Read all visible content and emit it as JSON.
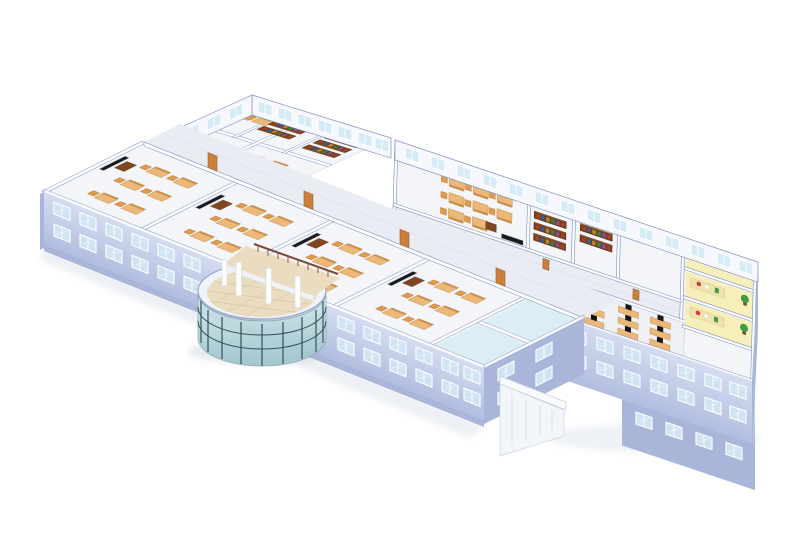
{
  "canvas": {
    "width": 800,
    "height": 550,
    "background": "#ffffff"
  },
  "palette": {
    "wall_ext": "#c3cee9",
    "wall_ext_dark": "#a9b5d9",
    "wall_top": "#f8fafd",
    "wall_stroke": "#7e90c0",
    "wall_white": "#fdfdff",
    "wall_white_face": "#f6f8fd",
    "floor_room": "#f4f5f8",
    "floor_corr": "#e9ecf2",
    "floor_line": "#d9dde6",
    "win_glass": "#cfe3f2",
    "win_glass_int": "#d6ebf8",
    "win_frame": "#ffffff",
    "door_wood": "#c9803c",
    "door_wood_dark": "#9c5f28",
    "board_dark": "#1a1b1f",
    "desk_top": "#ecb877",
    "desk_side": "#c98f4e",
    "chair_orange": "#e09a4e",
    "dark_wood": "#7c4722",
    "shelf_dark": "#6f3f1d",
    "book1": "#a5402c",
    "book2": "#2f5f9e",
    "book3": "#b8862f",
    "book4": "#3f7f46",
    "book5": "#8a4a9e",
    "lab_yellow": "#f7efb9",
    "lab_bench": "#efe2ae",
    "plant_green": "#3f9b44",
    "item_red": "#d23b2f",
    "pc_chair": "#1e1f24",
    "monitor_dark": "#15161a",
    "elev_door": "#26262c",
    "elev_floor": "#f0e6a0",
    "atrium_floor": "#e9dcc0",
    "atrium_check": "#d8c8a6",
    "glass_hi": "#d6ecee",
    "glass_lo": "#9cc3ca",
    "glass_mullion": "#33505a",
    "rail_wood": "#7a4a34",
    "bath_floor": "#dcedf6",
    "shadow": "#c3ccdb",
    "stair_white": "#f2f5fa",
    "stair_line": "#ccd4e2"
  },
  "scene": {
    "type": "isometric-building-cutaway",
    "view": "3d-floorplan-render",
    "areas": [
      {
        "name": "front-classroom-wing",
        "rooms": 4,
        "furniture": [
          "blackboard",
          "teacher-desk",
          "student-desks",
          "orange-chairs"
        ],
        "exterior_window_rows": 2
      },
      {
        "name": "washroom-section",
        "rooms": 2
      },
      {
        "name": "back-library-block",
        "bookshelf_rooms": 2,
        "classrooms": 3,
        "exterior_window_band": true
      },
      {
        "name": "right-wing",
        "bookshelf_rooms": 2,
        "classrooms": 1,
        "exterior_window_rows": 2
      },
      {
        "name": "computer-lab",
        "stations": 9,
        "chair_color": "black"
      },
      {
        "name": "science-lab-rooms-yellow",
        "rooms": 3,
        "furniture": [
          "workbench",
          "plant",
          "red-equipment"
        ]
      },
      {
        "name": "elevator-core",
        "elevators": 2,
        "floor": "yellow-tile",
        "stair": true
      },
      {
        "name": "glass-atrium",
        "shape": "cylinder",
        "columns": 4,
        "mullions": 9,
        "rails": 2,
        "balcony_railing": true
      },
      {
        "name": "exterior-stair-southeast",
        "flights": 1
      },
      {
        "name": "connecting-corridors",
        "count": 3
      }
    ]
  }
}
